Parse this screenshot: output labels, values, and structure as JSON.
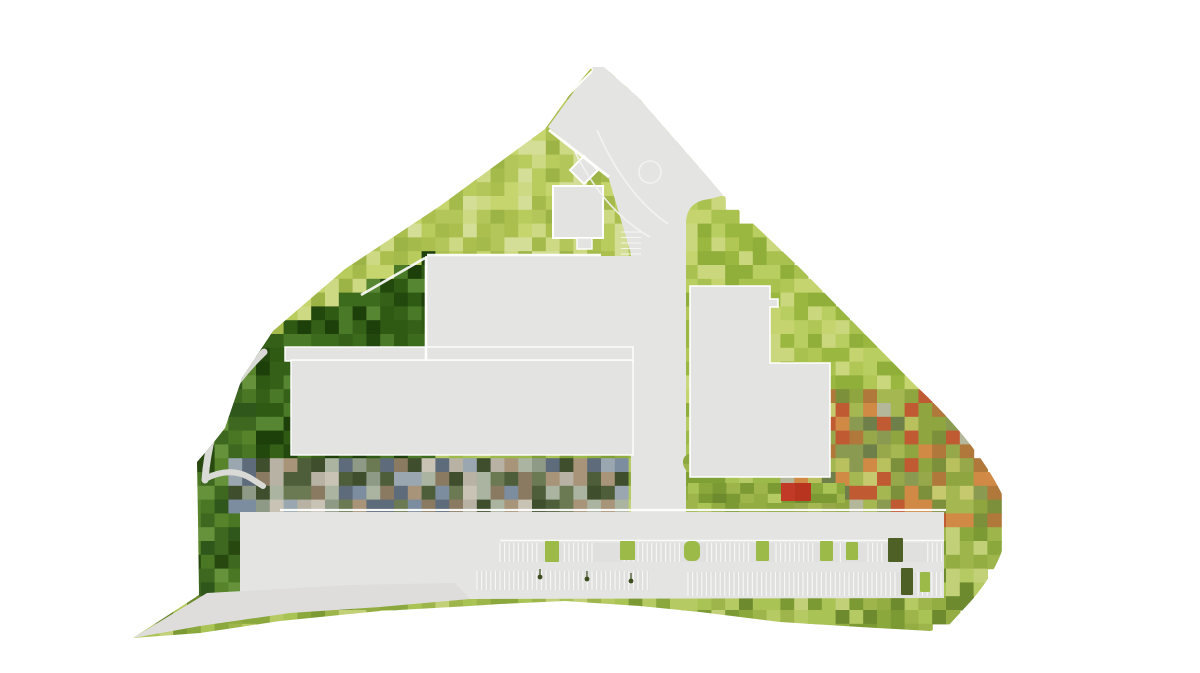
{
  "canvas": {
    "width": 1200,
    "height": 673,
    "background": "#ffffff"
  },
  "colors": {
    "ground": "#e4e4e2",
    "ground_sail": "#dedddb",
    "building": "#e3e3e1",
    "building_stroke": "#ffffff",
    "footpath": "#d9d9d6",
    "road_marking": "#f3f3f1",
    "white_line": "#ffffff",
    "row_shade": "#dcdcd9",
    "tree": "#9cba48",
    "tree_dark": "#4e6026",
    "lamp": "#3c4c1e",
    "red_roof_1": "#c13a28",
    "red_roof_2": "#b8341f",
    "median_segments": [
      "#a8bc4f",
      "#bac961",
      "#93a83e",
      "#c3cf6b",
      "#9fb54a"
    ]
  },
  "mosaic": {
    "seed": 7,
    "cell": 13.8,
    "palettes": {
      "mixed_strip": [
        "#9aa7b0",
        "#7d8da0",
        "#b8b2a4",
        "#c9c3b6",
        "#8a7a62",
        "#6b7a52",
        "#4e5e3a",
        "#aab4a0",
        "#5d6b7a",
        "#8f9a86",
        "#a89478",
        "#3f4f2e"
      ],
      "column_dark": [
        "#3e681f",
        "#2f561b",
        "#4a7724",
        "#57842b",
        "#27490f",
        "#65923a"
      ],
      "forest_dark": [
        "#2f5a14",
        "#3c6b1d",
        "#23480d",
        "#4a7a27",
        "#1d3f0a",
        "#578633",
        "#356018"
      ],
      "bright_top": [
        "#aabf4e",
        "#b8cb5d",
        "#c6d56e",
        "#9cb445",
        "#cdd983",
        "#b2c659",
        "#a4ba4a",
        "#d4de96"
      ],
      "bright_right": [
        "#a9c24f",
        "#b9ce60",
        "#9ab83f",
        "#c5d46f",
        "#8fae3a",
        "#b0c655",
        "#cbd77d"
      ],
      "autumn": [
        "#a4b751",
        "#8fa53f",
        "#b9c05e",
        "#7c8f3a",
        "#c7c96e",
        "#b0783a",
        "#d08a45",
        "#97a84b",
        "#6f7f49",
        "#b4b79a",
        "#8a9a50",
        "#c05a32"
      ],
      "bottom_band": [
        "#9db54a",
        "#aac355",
        "#8aa83c",
        "#b6ca63",
        "#7b9a33",
        "#c2d077",
        "#93ad42",
        "#6d8a2e"
      ],
      "patch_green": [
        "#9db54a",
        "#8aa83c",
        "#a9bf52",
        "#7b9a33",
        "#b0c25e",
        "#88a040"
      ],
      "default_mid": [
        "#8fae3f",
        "#9cba4a",
        "#a9c355",
        "#7fa034",
        "#b5ca64"
      ]
    }
  },
  "parking": {
    "tick_spacing": 4.6,
    "tick_opacity": 0.78,
    "rows": [
      {
        "x1": 500,
        "x2": 944,
        "y": 543,
        "h": 19,
        "gaps": [
          [
            540,
            563
          ],
          [
            596,
            622
          ],
          [
            680,
            703
          ],
          [
            752,
            773
          ],
          [
            816,
            838
          ],
          [
            843,
            864
          ],
          [
            884,
            924
          ]
        ]
      },
      {
        "x1": 477,
        "x2": 649,
        "y": 571,
        "h": 19,
        "gaps": []
      },
      {
        "x1": 688,
        "x2": 942,
        "y": 572,
        "h": 24,
        "gaps": [
          [
            898,
            918
          ]
        ]
      }
    ],
    "trees": [
      {
        "x": 545,
        "y": 541,
        "w": 14,
        "h": 21,
        "fill": "tree",
        "rx": 1
      },
      {
        "x": 620,
        "y": 541,
        "w": 15,
        "h": 19,
        "fill": "tree",
        "rx": 1
      },
      {
        "x": 684,
        "y": 541,
        "w": 16,
        "h": 20,
        "fill": "tree",
        "rx": 6
      },
      {
        "x": 756,
        "y": 541,
        "w": 13,
        "h": 20,
        "fill": "tree",
        "rx": 1
      },
      {
        "x": 820,
        "y": 541,
        "w": 13,
        "h": 20,
        "fill": "tree",
        "rx": 1
      },
      {
        "x": 846,
        "y": 542,
        "w": 12,
        "h": 18,
        "fill": "tree",
        "rx": 1
      },
      {
        "x": 888,
        "y": 538,
        "w": 15,
        "h": 24,
        "fill": "tree_dark",
        "rx": 1
      },
      {
        "x": 901,
        "y": 568,
        "w": 12,
        "h": 27,
        "fill": "tree_dark",
        "rx": 1
      },
      {
        "x": 920,
        "y": 572,
        "w": 10,
        "h": 20,
        "fill": "tree",
        "rx": 1
      }
    ],
    "lamps": [
      [
        540,
        577
      ],
      [
        587,
        579
      ],
      [
        631,
        581
      ]
    ],
    "mini_tick_ys": [
      232,
      237.5,
      243,
      248.5,
      254
    ]
  },
  "red_roofs": [
    {
      "x": 781,
      "y": 483,
      "w": 15,
      "h": 18,
      "fill": "red_roof_1"
    },
    {
      "x": 795,
      "y": 483,
      "w": 16,
      "h": 18,
      "fill": "red_roof_2"
    }
  ]
}
